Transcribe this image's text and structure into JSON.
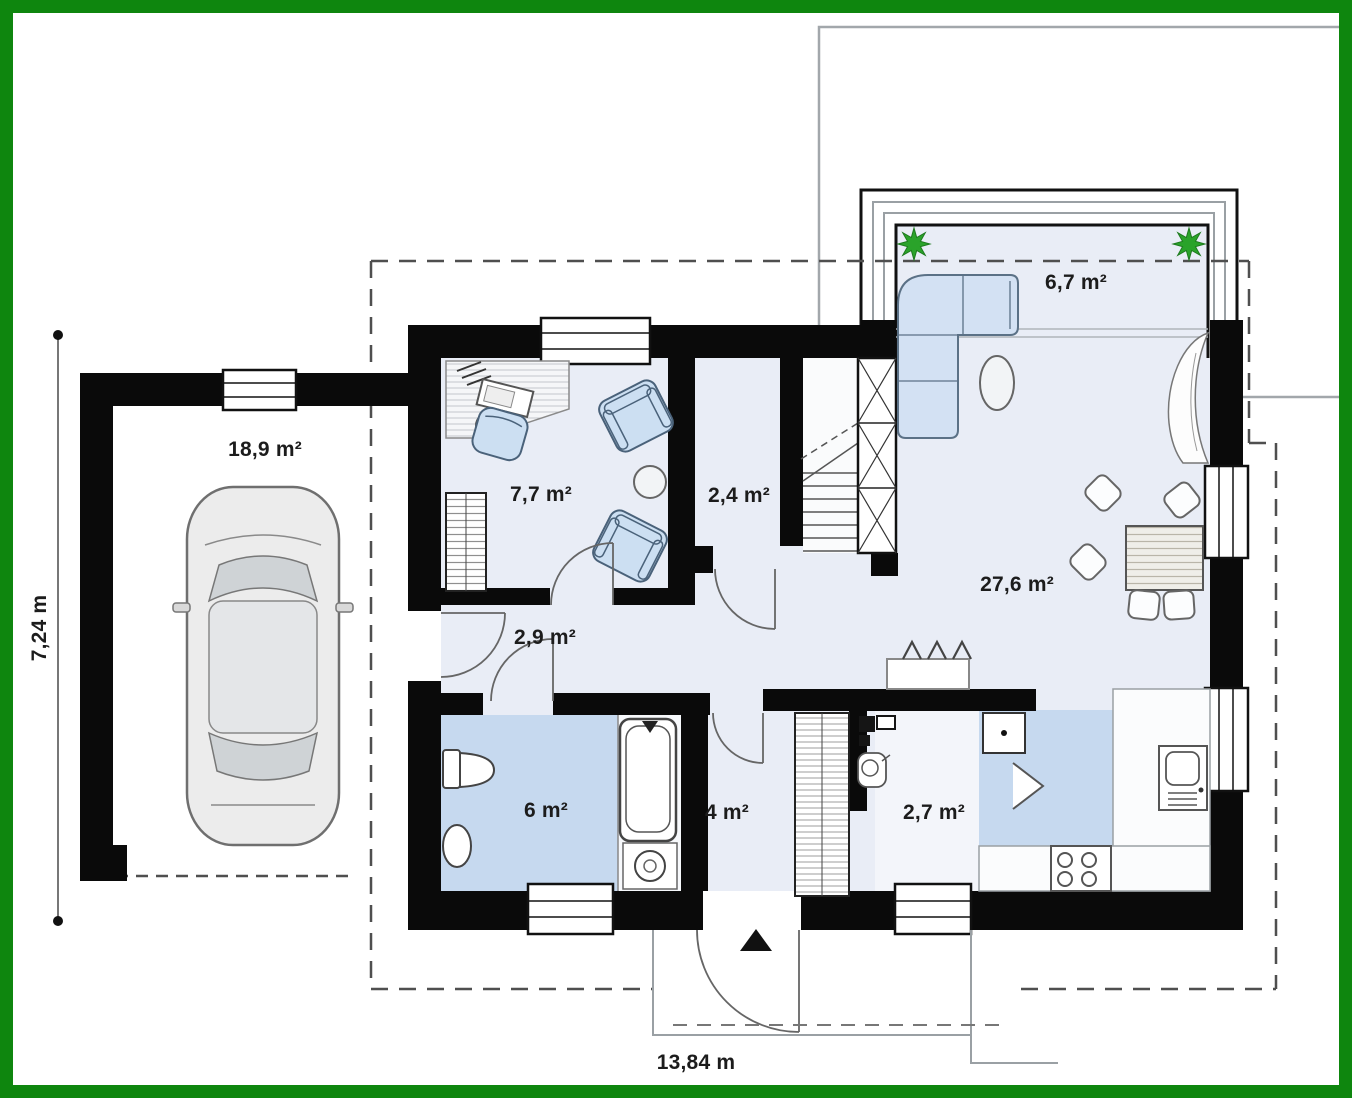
{
  "rooms": {
    "garage": "18,9 m²",
    "study": "7,7 m²",
    "closet": "2,4 m²",
    "terrace": "6,7 m²",
    "living": "27,6 m²",
    "hall": "2,9 m²",
    "bathroom": "6 m²",
    "entry_hall": "4 m²",
    "utility": "2,7 m²"
  },
  "dimensions": {
    "width": "13,84 m",
    "height": "7,24 m"
  },
  "colors": {
    "frame_green": "#0e860e",
    "wall_black": "#0a0a0a",
    "floor_light": "#e9edf6",
    "floor_blue": "#c6d9ef",
    "furniture_blue": "#d3e1f3",
    "plant_green": "#2aa32a"
  },
  "symbols": {
    "entrance_marker": "up-arrow-triangle"
  }
}
